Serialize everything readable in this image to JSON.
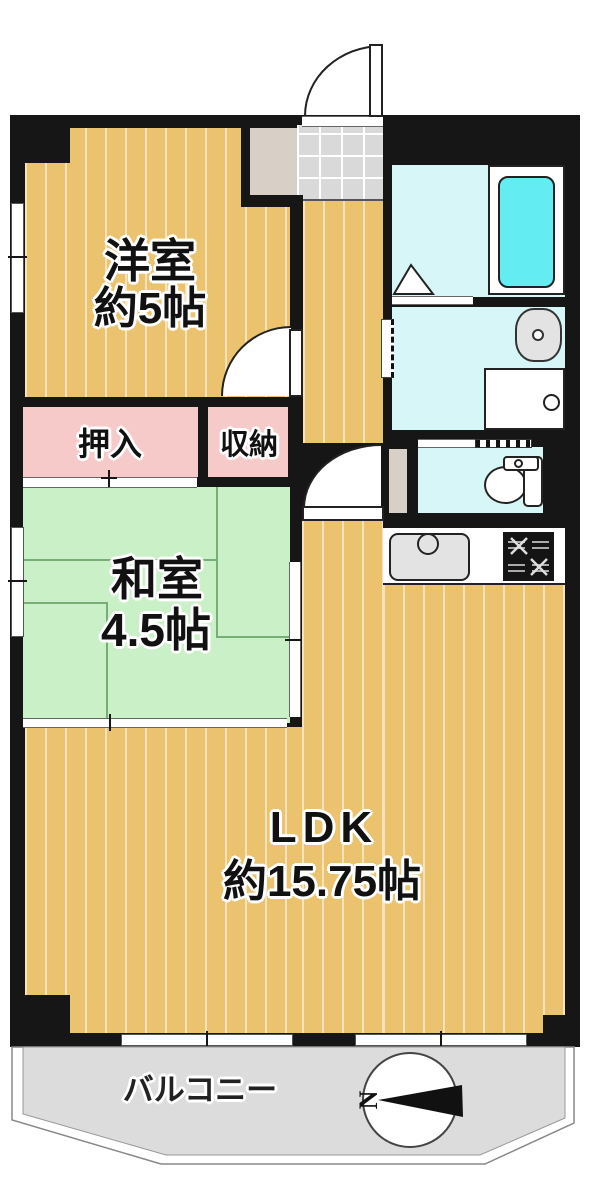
{
  "plan_type": "floor-plan",
  "rooms": {
    "western": {
      "label": "洋室",
      "size": "約5帖"
    },
    "japanese": {
      "label": "和室",
      "size": "4.5帖"
    },
    "ldk": {
      "label": "LDK",
      "size": "約15.75帖"
    },
    "closet": {
      "label": "押入"
    },
    "storage": {
      "label": "収納"
    },
    "balcony": {
      "label": "バルコニー"
    }
  },
  "compass": {
    "north_label": "N"
  },
  "colors": {
    "wall": "#161616",
    "wood_floor": "#ebc26d",
    "tatami_green": "#c9f0c6",
    "closet_pink": "#f7caca",
    "wet_area_cyan": "#d7f6f7",
    "bathtub_cyan": "#63ecf2",
    "entry_tile_gray": "#d9d9d9",
    "balcony_gray": "#dcdcdc"
  }
}
